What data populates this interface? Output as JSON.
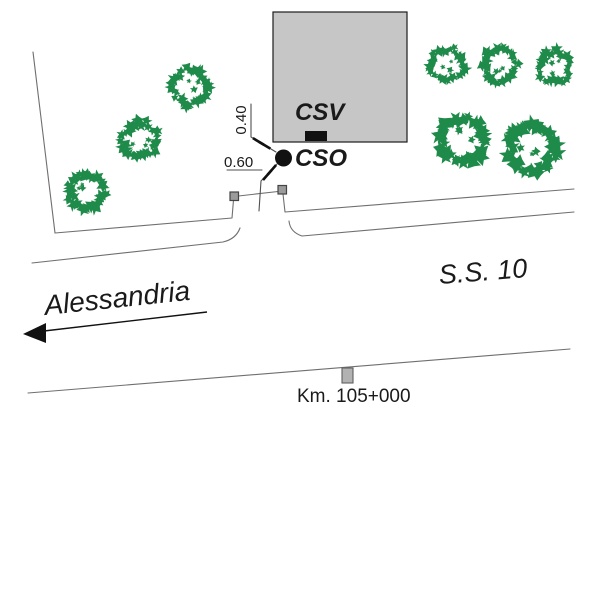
{
  "page": {
    "width": 600,
    "height": 600,
    "background": "#ffffff"
  },
  "annotations": {
    "csv-label": {
      "text": "CSV",
      "x": 295,
      "y": 100,
      "fs": 24,
      "bold": true,
      "italic": true
    },
    "cso-label": {
      "text": "CSO",
      "x": 295,
      "y": 146,
      "fs": 24,
      "bold": true,
      "italic": true
    },
    "dim-040-label": {
      "text": "0.40",
      "x": 222,
      "y": 111,
      "w": 40,
      "h": 18,
      "fs": 15,
      "rot": -90,
      "origin": "center",
      "center": true
    },
    "dim-060-label": {
      "text": "0.60",
      "x": 224,
      "y": 155,
      "fs": 15
    },
    "road-name-label": {
      "text": "S.S. 10",
      "x": 440,
      "y": 261,
      "fs": 27,
      "italic": true,
      "rot": -4.5,
      "origin": "0 100%"
    },
    "direction-label": {
      "text": "Alessandria",
      "x": 46,
      "y": 291,
      "fs": 28,
      "italic": true,
      "rot": -6,
      "origin": "0 100%"
    },
    "km-label": {
      "text": "Km. 105+000",
      "x": 297,
      "y": 387,
      "fs": 19
    }
  },
  "colors": {
    "tree": "#1f8b4a",
    "building_fill": "#c6c6c6",
    "building_stroke": "#1c1c1c",
    "line": "#6f6f6f",
    "dim": "#4f4f4f",
    "ink": "#111111",
    "post_fill": "#9b9b9b",
    "post_stroke": "#444444",
    "km_post_fill": "#b2b2b2",
    "km_post_stroke": "#5f5f5f",
    "text": "#1a1a1a"
  },
  "map": {
    "building": {
      "x": 273,
      "y": 12,
      "w": 134,
      "h": 130
    },
    "csv_marker": {
      "x": 305,
      "y": 131,
      "w": 22,
      "h": 10
    },
    "cso_marker": {
      "cx": 283.5,
      "cy": 158,
      "r": 8.5
    },
    "posts": [
      {
        "x": 230,
        "y": 192,
        "w": 8.5,
        "h": 8.5
      },
      {
        "x": 278,
        "y": 185.5,
        "w": 8.5,
        "h": 8.5
      }
    ],
    "km_post": {
      "x": 342,
      "y": 368,
      "w": 11,
      "h": 15
    },
    "trees": [
      {
        "cx": 190,
        "cy": 87,
        "r": 19
      },
      {
        "cx": 140,
        "cy": 140,
        "r": 19
      },
      {
        "cx": 87,
        "cy": 192,
        "r": 19
      },
      {
        "cx": 447,
        "cy": 65,
        "r": 18
      },
      {
        "cx": 500,
        "cy": 65,
        "r": 18
      },
      {
        "cx": 555,
        "cy": 67,
        "r": 17
      },
      {
        "cx": 463,
        "cy": 140,
        "r": 24
      },
      {
        "cx": 532,
        "cy": 148,
        "r": 24
      }
    ],
    "paths": [
      {
        "name": "property-boundary-line",
        "d": "M33,52 L55,233 L232,218 L233.5,200",
        "c": "line"
      },
      {
        "name": "gate-line",
        "d": "M238.5,196 L278,191.5",
        "c": "line"
      },
      {
        "name": "road-edge-right-upper",
        "d": "M283,194 L285,212 L574,189",
        "c": "line"
      },
      {
        "name": "road-edge-left-lower",
        "d": "M32,263 L223,242 Q236,239 240,228",
        "c": "line"
      },
      {
        "name": "road-edge-right-lower",
        "d": "M289,221 Q290,232 302,236 L574,212",
        "c": "line"
      },
      {
        "name": "road-far-edge",
        "d": "M28,393 L570,349",
        "c": "line"
      },
      {
        "name": "dim-040-leader",
        "d": "M251,104 L251,137 L276,152",
        "c": "dim"
      },
      {
        "name": "dim-060-underline",
        "d": "M227,170 L262,170",
        "c": "dim"
      },
      {
        "name": "dim-060-leader",
        "d": "M277,164 L261,181 L259,211",
        "c": "dim"
      }
    ],
    "ticks": [
      {
        "x": 258.5,
        "y": 141.5,
        "rot": -59
      },
      {
        "x": 264.8,
        "y": 145.3,
        "rot": -59
      },
      {
        "x": 271.8,
        "y": 169.9,
        "rot": 41
      },
      {
        "x": 267.3,
        "y": 175.1,
        "rot": 41
      }
    ],
    "arrow": {
      "line": "M44,331 L207,312",
      "head": "23,334 46,323 46,343"
    }
  }
}
